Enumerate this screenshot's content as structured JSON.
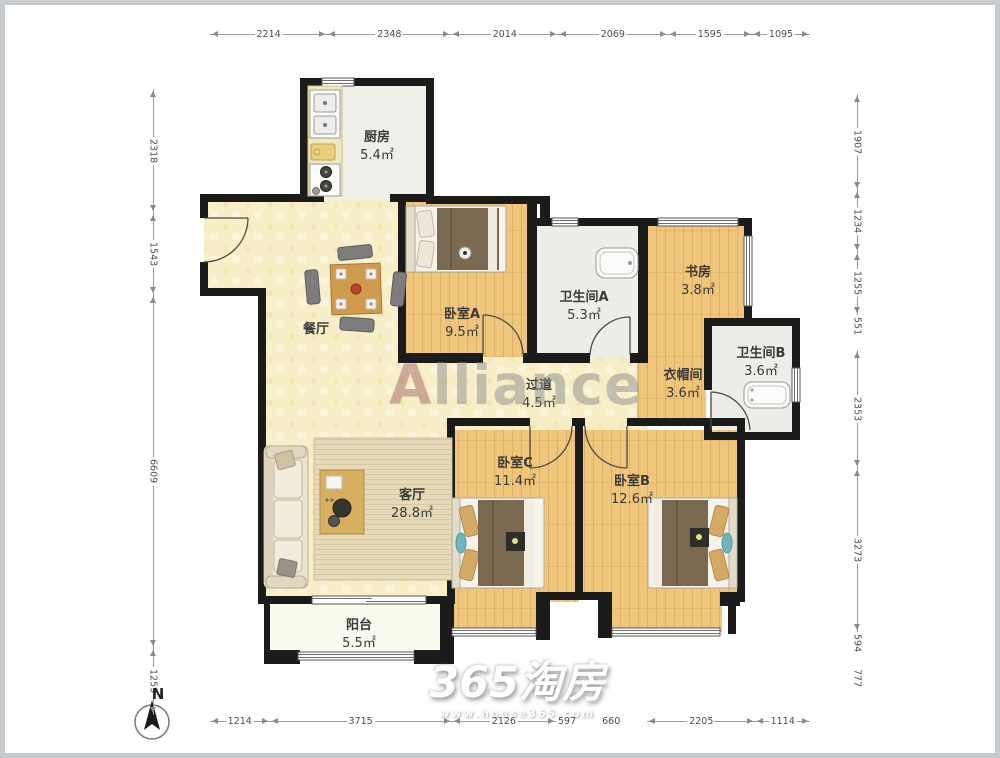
{
  "rooms": [
    {
      "name": "厨房",
      "area": "5.4㎡"
    },
    {
      "name": "餐厅",
      "area": ""
    },
    {
      "name": "卧室A",
      "area": "9.5㎡"
    },
    {
      "name": "卫生间A",
      "area": "5.3㎡"
    },
    {
      "name": "书房",
      "area": "3.8㎡"
    },
    {
      "name": "衣帽间",
      "area": "3.6㎡"
    },
    {
      "name": "卫生间B",
      "area": "3.6㎡"
    },
    {
      "name": "过道",
      "area": "4.5㎡"
    },
    {
      "name": "客厅",
      "area": "28.8㎡"
    },
    {
      "name": "卧室C",
      "area": "11.4㎡"
    },
    {
      "name": "卧室B",
      "area": "12.6㎡"
    },
    {
      "name": "阳台",
      "area": "5.5㎡"
    }
  ],
  "dimensions": {
    "top": [
      "2214",
      "2348",
      "2014",
      "2069",
      "1595",
      "1095"
    ],
    "bottom": [
      "1214",
      "3715",
      "2126",
      "597",
      "660",
      "2205",
      "1114"
    ],
    "left": [
      "2318",
      "1543",
      "6609",
      "1259"
    ],
    "right": [
      "1907",
      "1234",
      "1255",
      "551",
      "2353",
      "3273",
      "594",
      "777"
    ]
  },
  "watermarks": {
    "center": "Alliance",
    "logo": "365淘房",
    "site": "www.house365.com"
  },
  "compass": {
    "label": "N"
  },
  "colors": {
    "wall": "#1b1b1b",
    "wood_floor": "#f0c67c",
    "living_floor": "#f8efc9",
    "tile_floor": "#eeede9",
    "balcony_floor": "#fbfaef",
    "accent_teal": "#6fb6c0"
  }
}
